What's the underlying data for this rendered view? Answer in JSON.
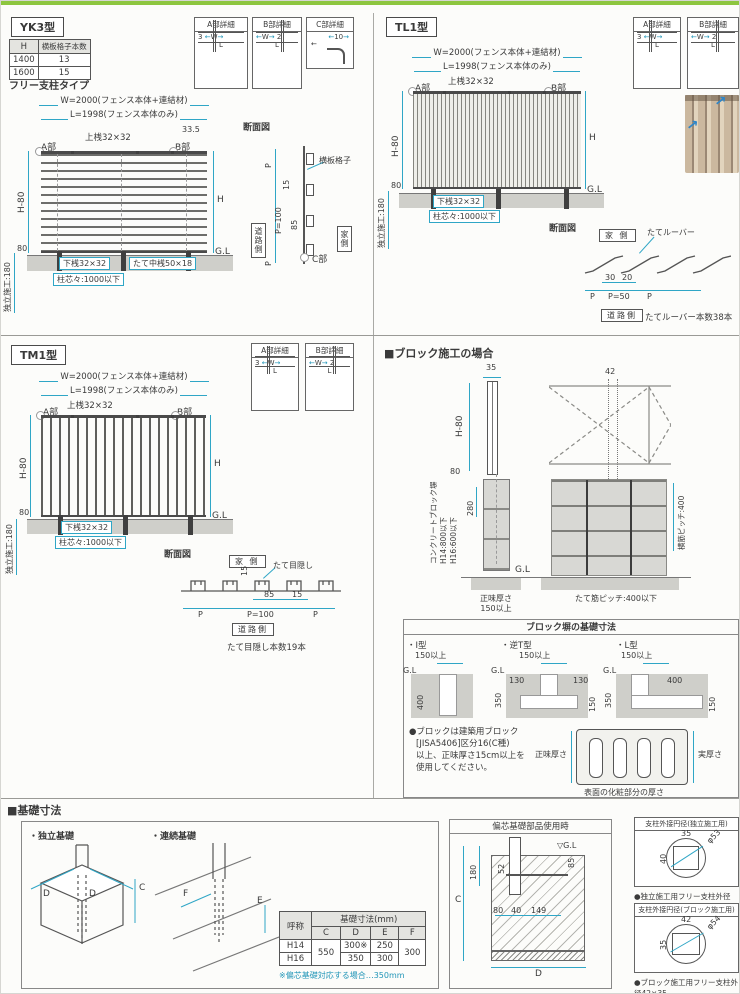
{
  "page": {
    "accent_green": "#8dc63f",
    "dim_color": "#2fa6c6"
  },
  "yk3": {
    "title": "YK3型",
    "subtitle": "フリー支柱タイプ",
    "table": {
      "h_header": "H",
      "count_header": "横板格子本数",
      "rows": [
        {
          "h": "1400",
          "count": "13"
        },
        {
          "h": "1600",
          "count": "15"
        }
      ]
    },
    "labels": {
      "w_dim": "W=2000(フェンス本体+連結材)",
      "l_dim": "L=1998(フェンス本体のみ)",
      "d335": "33.5",
      "top_rail": "上桟32×32",
      "a": "A部",
      "b": "B部",
      "h80": "H-80",
      "h": "H",
      "d80": "80",
      "install": "独立施工:180",
      "bottom_rail": "下桟32×32",
      "pitch": "柱芯々:1000以下",
      "mid_rail": "たて中桟50×18",
      "gl": "G.L"
    },
    "section": {
      "title": "断面図",
      "p_top": "P",
      "d15": "15",
      "p100": "P=100",
      "d85": "85",
      "p_bot": "P",
      "road": "道路側",
      "home": "家側",
      "slat": "横板格子",
      "c": "C部"
    },
    "details": {
      "a_title": "A部詳細",
      "a_d1": "3",
      "a_d2": "W",
      "a_d3": "L",
      "b_title": "B部詳細",
      "b_d1": "W",
      "b_d2": "L",
      "b_d3": "2",
      "c_title": "C部詳細",
      "c_d1": "10"
    }
  },
  "tl1": {
    "title": "TL1型",
    "labels": {
      "w_dim": "W=2000(フェンス本体+連結材)",
      "l_dim": "L=1998(フェンス本体のみ)",
      "top_rail": "上桟32×32",
      "a": "A部",
      "b": "B部",
      "h80": "H-80",
      "h": "H",
      "d80": "80",
      "install": "独立施工:180",
      "bottom_rail": "下桟32×32",
      "pitch": "柱芯々:1000以下",
      "gl": "G.L"
    },
    "section": {
      "title": "断面図",
      "home": "家 側",
      "louver": "たてルーバー",
      "d30": "30",
      "d20": "20",
      "p1": "P",
      "p50": "P=50",
      "p2": "P",
      "road": "道路側",
      "count": "たてルーバー本数38本"
    },
    "details": {
      "a_title": "A部詳細",
      "a_d1": "3",
      "a_d2": "W",
      "a_d3": "L",
      "b_title": "B部詳細",
      "b_d1": "W",
      "b_d2": "L",
      "b_d3": "2"
    }
  },
  "tm1": {
    "title": "TM1型",
    "labels": {
      "w_dim": "W=2000(フェンス本体+連結材)",
      "l_dim": "L=1998(フェンス本体のみ)",
      "top_rail": "上桟32×32",
      "a": "A部",
      "b": "B部",
      "h80": "H-80",
      "h": "H",
      "d80": "80",
      "install": "独立施工:180",
      "bottom_rail": "下桟32×32",
      "pitch": "柱芯々:1000以下",
      "gl": "G.L"
    },
    "section": {
      "title": "断面図",
      "home": "家 側",
      "screen": "たて目隠し",
      "d15a": "15",
      "d85": "85",
      "d15b": "15",
      "p1": "P",
      "p100": "P=100",
      "p2": "P",
      "road": "道路側",
      "count": "たて目隠し本数19本"
    },
    "details": {
      "a_title": "A部詳細",
      "a_d1": "3",
      "a_d2": "W",
      "a_d3": "L",
      "b_title": "B部詳細",
      "b_d1": "W",
      "b_d2": "L",
      "b_d3": "2"
    }
  },
  "block": {
    "title": "■ブロック施工の場合",
    "side": {
      "d35": "35",
      "h80": "H-80",
      "d80": "80",
      "d280": "280",
      "wall1": "コンクリートブロック塀",
      "wall2": "H14:800以下",
      "wall3": "H16:600以下",
      "gl": "G.L",
      "net1": "正味厚さ",
      "net2": "150以上"
    },
    "front": {
      "d42": "42",
      "tate_pitch": "たて筋ピッチ:400以下",
      "yoko_pitch": "横筋ピッチ:400"
    },
    "base_box": {
      "title": "ブロック塀の基礎寸法",
      "i_label": "・I型",
      "i_150": "150以上",
      "i_gl": "G.L",
      "i_400": "400",
      "t_label": "・逆T型",
      "t_150": "150以上",
      "t_gl": "G.L",
      "t_130l": "130",
      "t_130r": "130",
      "t_350": "350",
      "t_150b": "150",
      "l_label": "・L型",
      "l_150": "150以上",
      "l_gl": "G.L",
      "l_400": "400",
      "l_350": "350",
      "l_150b": "150"
    },
    "note": [
      "●ブロックは建築用ブロック",
      "[JISA5406]区分16(C種)",
      "以上、正味厚さ15cm以上を",
      "使用してください。"
    ],
    "cross": {
      "net": "正味厚さ",
      "actual": "実厚さ",
      "surface": "表面の化粧部分の厚さ"
    }
  },
  "foundation": {
    "title": "■基礎寸法",
    "independent": {
      "label": "・独立基礎",
      "d1": "D",
      "d2": "D",
      "c": "C"
    },
    "continuous": {
      "label": "・連続基礎",
      "f": "F",
      "e": "E"
    },
    "table": {
      "name_header": "呼称",
      "dim_header": "基礎寸法(mm)",
      "cols": [
        "C",
        "D",
        "E",
        "F"
      ],
      "h14": "H14",
      "h16": "H16",
      "c_val": "550",
      "d14": "300※",
      "d16": "350",
      "e14": "250",
      "e16": "300",
      "f_val": "300"
    },
    "note": "※偏芯基礎対応する場合…350mm",
    "eccentric": {
      "title": "偏芯基礎部品使用時",
      "gl": "▽G.L",
      "d180": "180",
      "c": "C",
      "d52": "52",
      "d85": "85",
      "d80": "80",
      "d40": "40",
      "d149": "149",
      "d": "D"
    },
    "circle1": {
      "title": "支柱外接円径(独立施工用)",
      "w": "35",
      "h": "40",
      "dia": "φ53",
      "note": "●独立施工用フリー支柱外径35×40"
    },
    "circle2": {
      "title": "支柱外接円径(ブロック施工用)",
      "w": "42",
      "h": "35",
      "dia": "φ54",
      "note": "●ブロック施工用フリー支柱外径42×35"
    }
  }
}
